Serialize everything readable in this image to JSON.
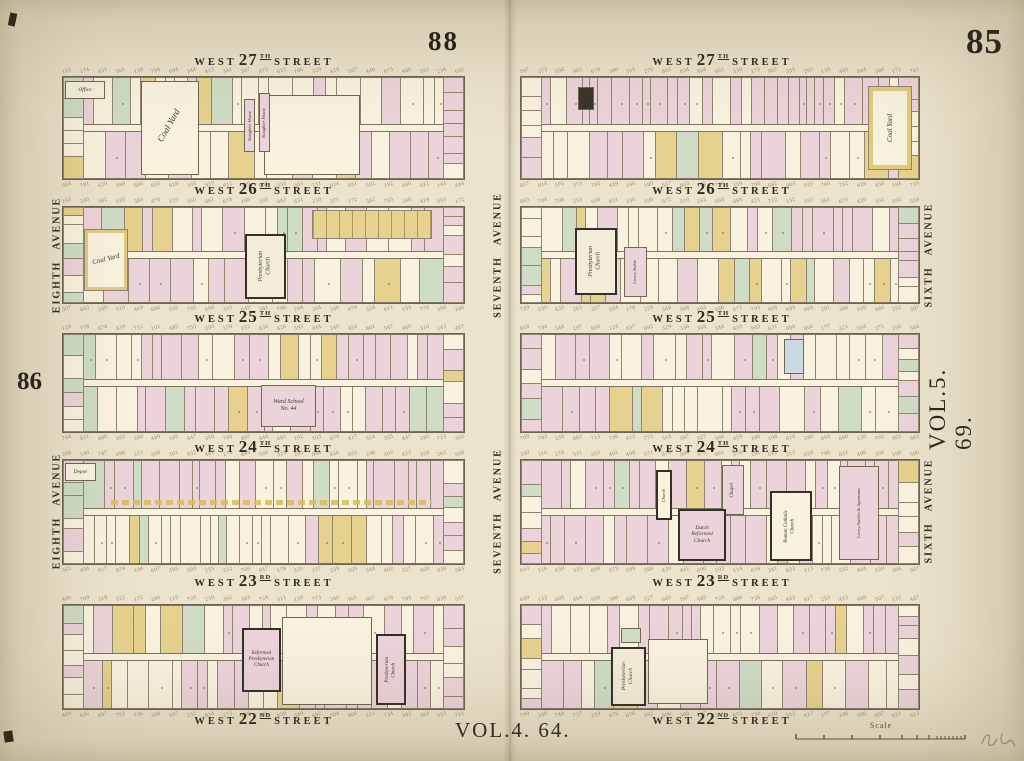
{
  "page": {
    "left_number": "88",
    "right_number": "85",
    "margin_left_number": "86",
    "volume_right": "VOL.5. 69.",
    "volume_bottom": "VOL.4. 64."
  },
  "scale": {
    "label": "Scale"
  },
  "avenues": {
    "left": "EIGHTH AVENUE",
    "middle": "SEVENTH AVENUE",
    "right": "SIXTH AVENUE"
  },
  "streets": [
    {
      "prefix": "WEST",
      "number": "27",
      "ordinal": "TH",
      "suffix": "STREET"
    },
    {
      "prefix": "WEST",
      "number": "26",
      "ordinal": "TH",
      "suffix": "STREET"
    },
    {
      "prefix": "WEST",
      "number": "25",
      "ordinal": "TH",
      "suffix": "STREET"
    },
    {
      "prefix": "WEST",
      "number": "24",
      "ordinal": "TH",
      "suffix": "STREET"
    },
    {
      "prefix": "WEST",
      "number": "23",
      "ordinal": "RD",
      "suffix": "STREET"
    },
    {
      "prefix": "WEST",
      "number": "22",
      "ordinal": "ND",
      "suffix": "STREET"
    }
  ],
  "landmarks": {
    "office": "Office",
    "coal_yard": "Coal Yard",
    "slaughter_house": "Slaughter House",
    "presbyterian": "Presbyterian",
    "church": "Church",
    "reformed": "Reformed",
    "ward_school": "Ward School",
    "ward_school_no": "No. 44",
    "depot": "Depot",
    "livery_stable": "Livery Stable",
    "chapel": "Chapel",
    "dutch": "Dutch",
    "roman_catholic": "Roman Catholic",
    "livery_stables_apparatus": "Livery Stables & Apparatus"
  },
  "colors": {
    "paper": "#ebe3cc",
    "lot_white": "#f8f2df",
    "lot_pink": "#ecd3da",
    "lot_yellow": "#e6d28e",
    "lot_green": "#cfdcc6",
    "lot_blue": "#cbd9e2",
    "bold_outline": "#33302a"
  }
}
